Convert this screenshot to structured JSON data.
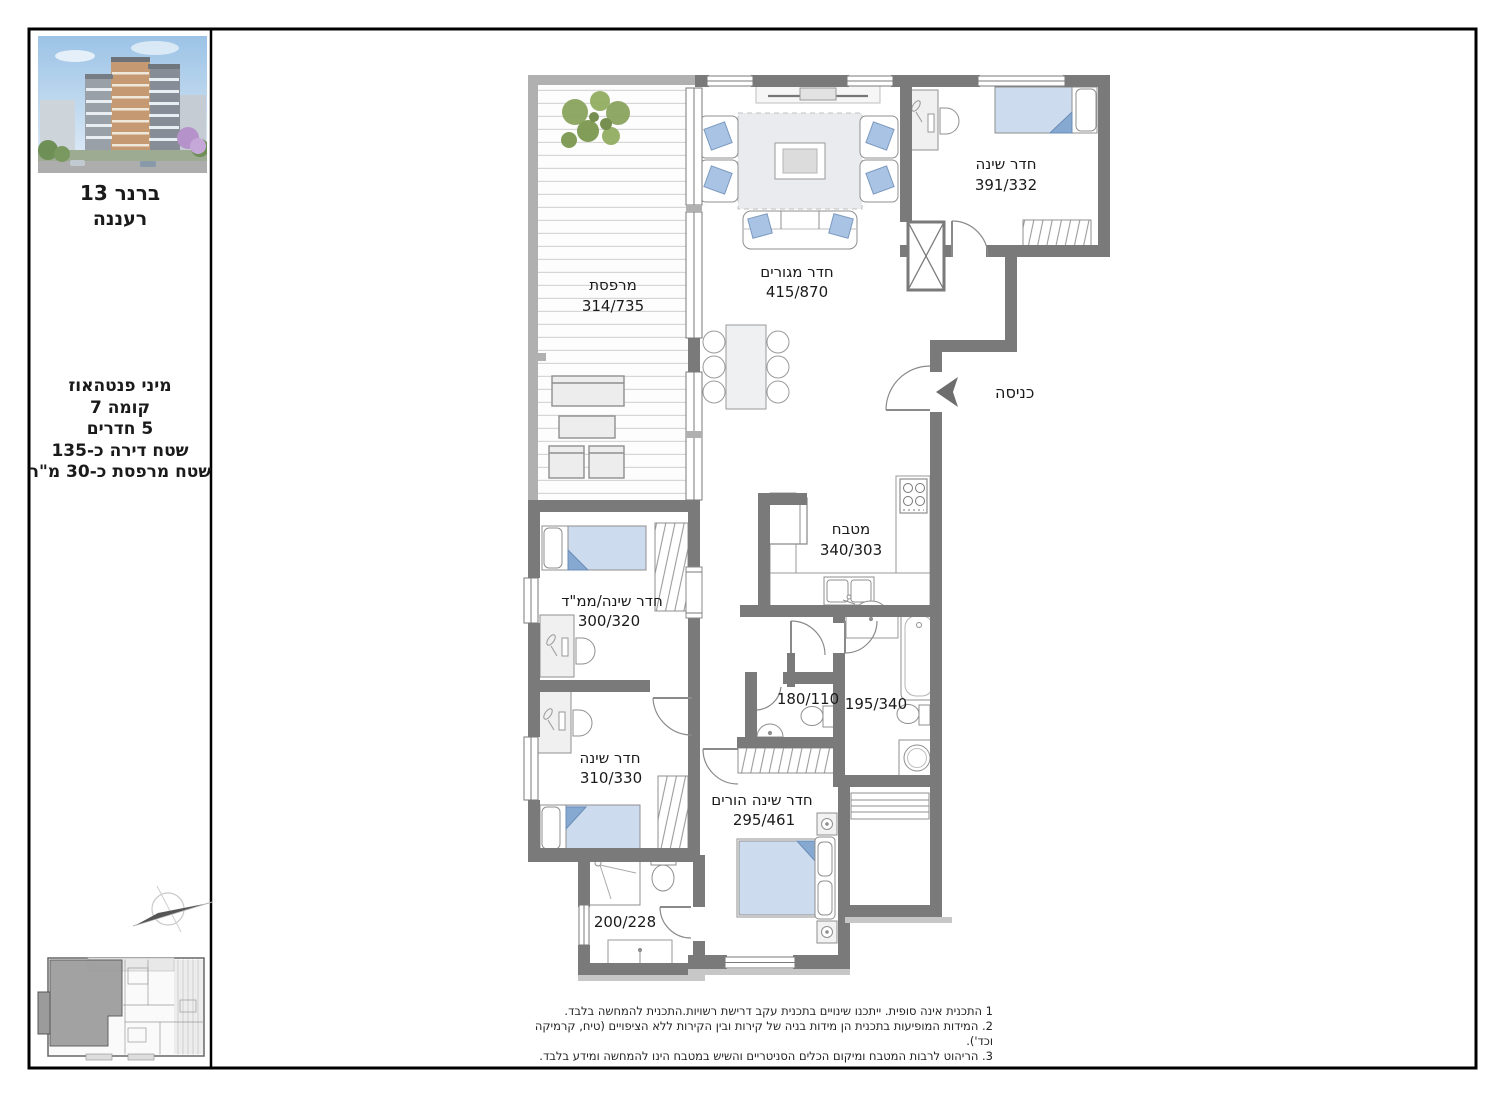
{
  "sheet": {
    "project": {
      "street": "ברנר 13",
      "city": "רעננה"
    },
    "unit_info": {
      "lines": [
        "מיני פנטהאוז",
        "קומה 7",
        "5 חדרים",
        "שטח דירה כ-135",
        "שטח מרפסת כ-30 מ\"ר"
      ]
    },
    "rooms": {
      "balcony": {
        "label": "מרפסת",
        "dims": "314/735"
      },
      "living": {
        "label": "חדר מגורים",
        "dims": "415/870"
      },
      "bedroom1": {
        "label": "חדר שינה",
        "dims": "391/332"
      },
      "entrance": {
        "label": "כניסה"
      },
      "kitchen": {
        "label": "מטבח",
        "dims": "340/303"
      },
      "mamad": {
        "label": "חדר שינה/ממ\"ד",
        "dims": "300/320"
      },
      "bedroom2": {
        "label": "חדר שינה",
        "dims": "310/330"
      },
      "wc": {
        "dims": "180/110"
      },
      "bath1": {
        "dims": "195/340"
      },
      "master": {
        "label": "חדר שינה הורים",
        "dims": "295/461"
      },
      "bath2": {
        "dims": "200/228"
      }
    },
    "notes": [
      "1 התכנית אינה סופית. ייתכנו שינויים בתכנית עקב דרישת רשויות.התכנית להמחשה בלבד.",
      "2. המידות המופיעות בתכנית הן מידות בניה של קירות ובין הקירות ללא הציפויים (טיח, קרמיקה וכד').",
      "3. הריהוט לרבות המטבח ומיקום הכלים הסניטריים והשיש במטבח הינו להמחשה ומידע בלבד."
    ],
    "colors": {
      "wall": "#7a7a7a",
      "parapet": "#b0b0b0",
      "blanket": "#ccdbee",
      "fold": "#86a9d1",
      "cushion": "#a9c3e5",
      "deck_line": "#d6d6d6"
    }
  }
}
